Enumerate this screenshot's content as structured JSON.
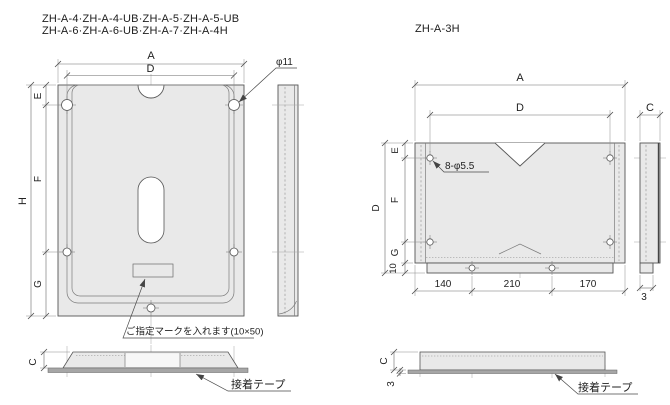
{
  "colors": {
    "background": "#ffffff",
    "plate_fill": "#e9e9e9",
    "tape_fill": "#a6a6a6",
    "outline": "#565656",
    "dimension_line": "#6b6b6b",
    "text": "#222222"
  },
  "left_drawing": {
    "title_line1": "ZH-A-4·ZH-A-4-UB·ZH-A-5·ZH-A-5-UB",
    "title_line2": "ZH-A-6·ZH-A-6-UB·ZH-A-7·ZH-A-4H",
    "dim_labels": {
      "overall_width": "A",
      "hole_pitch_width": "D",
      "overall_height": "H",
      "top_hole_offset": "E",
      "hole_pitch_height": "F",
      "bottom_hole_offset": "G",
      "thickness": "C",
      "hole_diameter": "φ11"
    },
    "annotations": {
      "mark_note": "ご指定マークを入れます(10×50)",
      "tape_label": "接着テープ"
    }
  },
  "right_drawing": {
    "title": "ZH-A-3H",
    "dim_labels": {
      "overall_width": "A",
      "hole_pitch_width": "D",
      "overall_height": "D",
      "top_hole_offset": "E",
      "hole_pitch_height": "F",
      "bottom_hole_offset": "G",
      "bottom_strip_height": "10",
      "thickness": "C",
      "strip_thickness": "3",
      "bottom_left_span": "140",
      "bottom_center_span": "210",
      "bottom_right_span": "170",
      "hole_callout": "8-φ5.5"
    },
    "annotations": {
      "tape_label": "接着テープ"
    }
  }
}
